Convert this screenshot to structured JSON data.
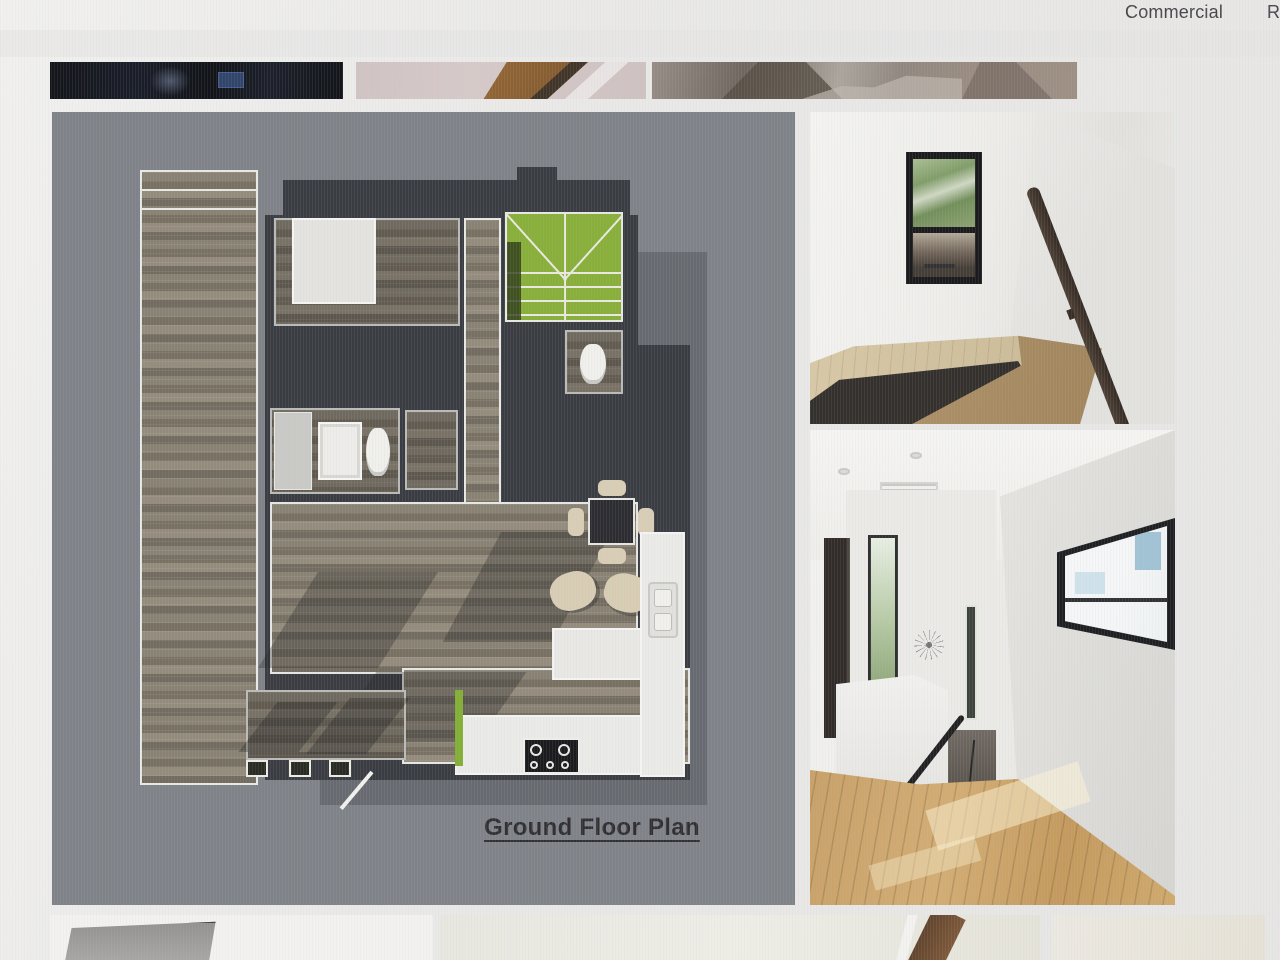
{
  "nav": {
    "items": [
      {
        "label": "Commercial"
      },
      {
        "label": "Res"
      }
    ]
  },
  "gallery": {
    "caption": "Ground Floor Plan",
    "top_thumbnails": [
      {
        "name": "dark-interior-thumbnail"
      },
      {
        "name": "carpet-and-wood-stair-thumbnail"
      },
      {
        "name": "stairwell-top-view-thumbnail"
      }
    ],
    "main_images": [
      {
        "name": "ground-floor-plan-rendering"
      },
      {
        "name": "stair-landing-window-photo"
      },
      {
        "name": "upstairs-hallway-photo"
      }
    ],
    "bottom_thumbnails": [
      {
        "name": "interior-corner-partial-thumbnail"
      },
      {
        "name": "stair-railing-partial-thumbnail"
      },
      {
        "name": "interior-wall-partial-thumbnail"
      }
    ]
  },
  "colors": {
    "plan_background": "#7c7f85",
    "plan_walls": "#34373c",
    "stair_green": "#85ad33",
    "plan_wood": "#867e6f",
    "hall_floor_oak": "#c79e63",
    "page_background": "#ecebe9",
    "caption_ink": "#2a2a2c",
    "nav_text": "#414044"
  }
}
